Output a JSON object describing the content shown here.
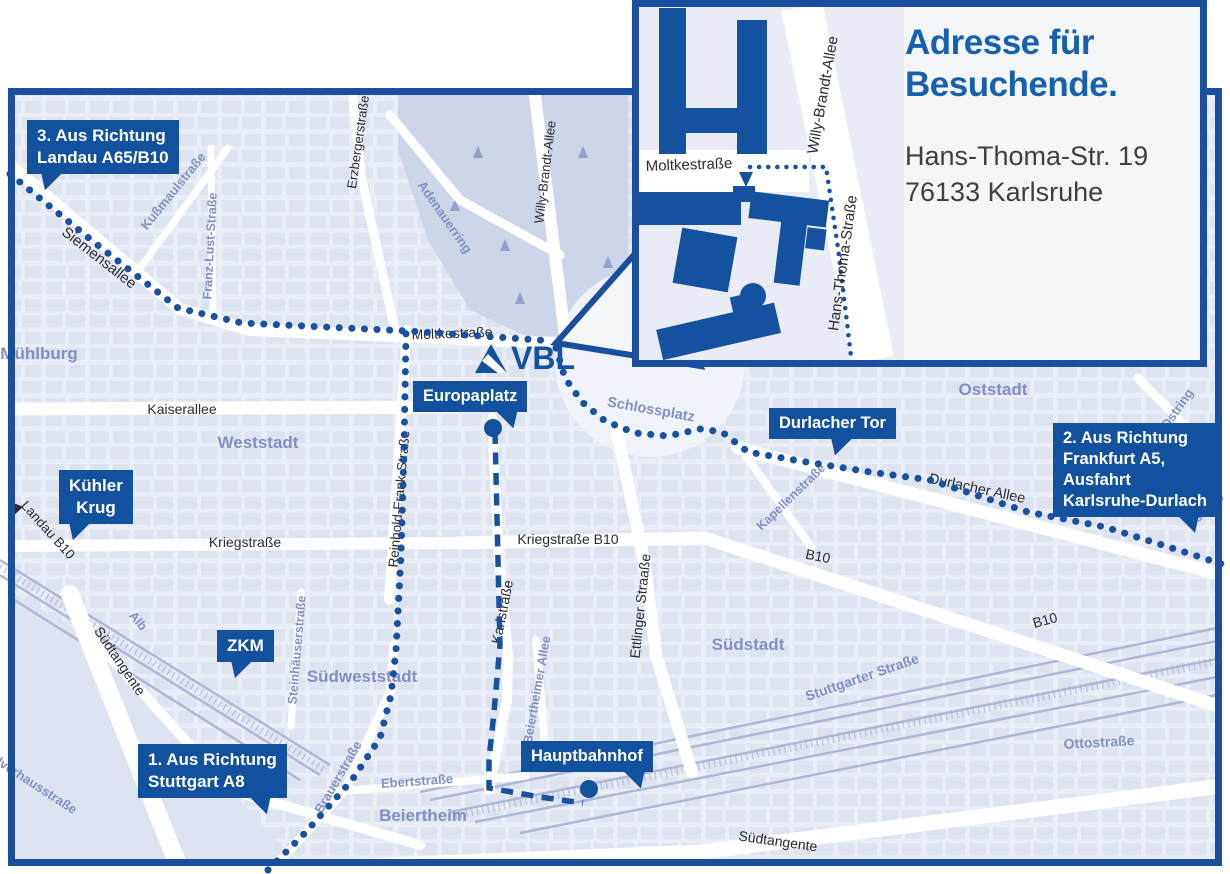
{
  "colors": {
    "brand_blue": "#14519e",
    "border_blue": "#1b4f9e",
    "title_blue": "#1561ae",
    "district_blue": "#8090c4",
    "street_black": "#2b2b30",
    "address_gray": "#3f3f41",
    "map_bg": "#eaedf5",
    "block_fill": "#dae0ee",
    "park_fill": "#cdd5e8",
    "rail_color": "#aeb8d6",
    "road_white": "#ffffff"
  },
  "logo": {
    "text": "VBL"
  },
  "callouts": {
    "route3": {
      "lines": [
        "3. Aus Richtung",
        "Landau A65/B10"
      ]
    },
    "kuehler_krug": {
      "lines": [
        "Kühler",
        "Krug"
      ]
    },
    "zkm": {
      "lines": [
        "ZKM"
      ]
    },
    "route1": {
      "lines": [
        "1. Aus Richtung",
        "Stuttgart A8"
      ]
    },
    "europaplatz": {
      "lines": [
        "Europaplatz"
      ]
    },
    "durlacher_tor": {
      "lines": [
        "Durlacher Tor"
      ]
    },
    "route2": {
      "lines": [
        "2. Aus Richtung",
        "Frankfurt A5,",
        "Ausfahrt",
        "Karlsruhe-Durlach"
      ]
    },
    "hauptbahnhof": {
      "lines": [
        "Hauptbahnhof"
      ]
    }
  },
  "streets": {
    "siemensallee": "Siemensallee",
    "moltkestrasse": "Moltkestraße",
    "kaiserallee": "Kaiserallee",
    "kriegstrasse": "Kriegstraße",
    "kriegstrasse_b10": "Kriegstraße B10",
    "karlstrasse": "Karlstraße",
    "ettlinger_strasse": "Ettlinger Straaße",
    "willy_brandt_allee": "Willy-Brandt-Allee",
    "erzbergerstrasse": "Erzbergerstraße",
    "reinhold_frank_strasse": "Reinhold-Frank-Straße",
    "durlacher_allee": "Durlacher Allee",
    "b10_a": "B10",
    "b10_b": "B10",
    "suedtangente_left": "Südtangente",
    "suedtangente_bottom": "Südtangente",
    "landau_b10": "Landau B10"
  },
  "districts": {
    "muehlburg": "Mühlburg",
    "weststadt": "Weststadt",
    "oststadt": "Oststadt",
    "suedstadt": "Südstadt",
    "suedweststadt": "Südweststadt",
    "beiertheim": "Beiertheim",
    "schlossplatz": "Schlossplatz",
    "adenauerring": "Adenauerring",
    "kussmaulstrasse": "Kußmaulstraße",
    "franz_lust_strasse": "Franz-Lust-Straße",
    "kapellenstrasse": "Kapellenstraße",
    "ostring": "Ostring",
    "ottostrasse": "Ottostraße",
    "stuttgarter_strasse": "Stuttgarter Straße",
    "alb": "Alb",
    "pulverhausstrasse": "Pulverhausstraße",
    "steinhaeuserstrasse": "Steinhäuserstraße",
    "brauerstrasse": "Brauerstraße",
    "ebertstrasse": "Ebertstraße",
    "beiertheimer_allee": "Beiertheimer Allee"
  },
  "inset": {
    "title_line1": "Adresse für",
    "title_line2": "Besuchende.",
    "address_line1": "Hans-Thoma-Str. 19",
    "address_line2": "76133 Karlsruhe",
    "streets": {
      "moltkestrasse": "Moltkestraße",
      "willy_brandt_allee": "Willy-Brandt-Allee",
      "hans_thoma_strasse": "Hans-Thoma-Straße"
    }
  }
}
